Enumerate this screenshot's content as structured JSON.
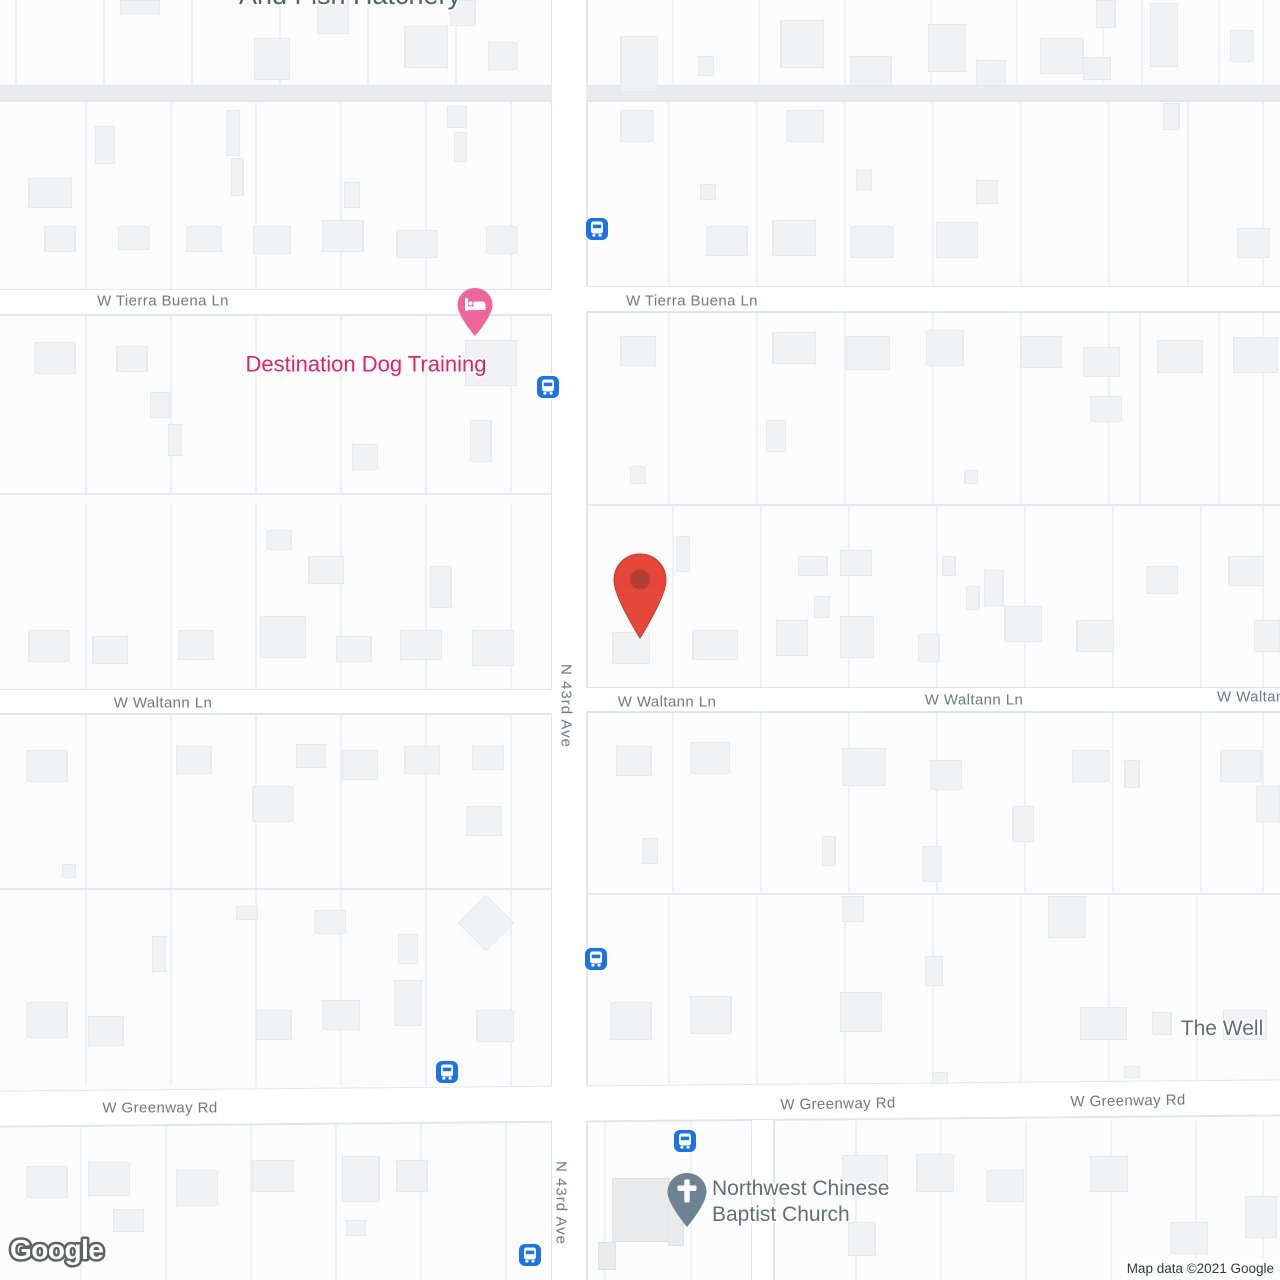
{
  "colors": {
    "land": "#fcfcfd",
    "road_fill": "#ffffff",
    "road_minor_fill": "#e9ebee",
    "road_casing": "#e2e5e9",
    "parcel_line": "#eef0f3",
    "building_fill": "#f1f2f4",
    "street_label": "#6b7a87",
    "poi_slate": "#5f7077",
    "poi_dark_slate": "#4a6570",
    "poi_pink": "#e8205f",
    "lodging_pin_pink": "#f0659a",
    "red_pin": "#e5473b",
    "red_pin_dot": "#b23e33",
    "church_pin": "#6d8292",
    "bus_blue": "#1a73e8",
    "watermark_outline": "#5e6267",
    "attribution_text": "#33373b"
  },
  "attribution": {
    "logo": "Google",
    "copyright": "Map data ©2021 Google"
  },
  "map": {
    "roads": [
      {
        "name": "road-top-minor",
        "type": "minor",
        "x": 0,
        "y": 86,
        "w": 1280,
        "h": 14
      },
      {
        "name": "road-tierra-buena-west",
        "type": "street",
        "x": 0,
        "y": 290,
        "w": 552,
        "h": 24
      },
      {
        "name": "road-tierra-buena-east",
        "type": "street",
        "x": 586,
        "y": 287,
        "w": 694,
        "h": 24
      },
      {
        "name": "road-waltann-west",
        "type": "street",
        "x": 0,
        "y": 690,
        "w": 552,
        "h": 23
      },
      {
        "name": "road-waltann-east",
        "type": "street",
        "x": 586,
        "y": 688,
        "w": 694,
        "h": 23
      },
      {
        "name": "road-n-43rd-ave",
        "type": "avenue",
        "x": 552,
        "y": 0,
        "w": 34,
        "h": 1280
      },
      {
        "name": "road-greenway",
        "type": "street",
        "x": -2,
        "y": 1086,
        "w": 1284,
        "h": 34,
        "rot": -0.5
      },
      {
        "name": "road-church-lane",
        "type": "lane",
        "x": 752,
        "y": 1120,
        "w": 21,
        "h": 160
      }
    ],
    "block_lines": [
      {
        "y": 493,
        "x1": 0,
        "x2": 552
      },
      {
        "y": 504,
        "x1": 586,
        "x2": 1280
      },
      {
        "y": 888,
        "x1": 0,
        "x2": 552
      },
      {
        "y": 893,
        "x1": 586,
        "x2": 1280
      }
    ],
    "parcel_groups": [
      {
        "xs": [
          15,
          103,
          191,
          279,
          367,
          455
        ],
        "y1": 0,
        "y2": 86
      },
      {
        "xs": [
          672,
          758,
          844,
          930,
          1016,
          1102,
          1141,
          1218,
          1262
        ],
        "y1": 0,
        "y2": 86
      },
      {
        "xs": [
          85,
          170,
          255,
          340,
          425,
          510
        ],
        "y1": 100,
        "y2": 290
      },
      {
        "xs": [
          668,
          756,
          844,
          932,
          1020,
          1108,
          1187,
          1262
        ],
        "y1": 100,
        "y2": 287
      },
      {
        "xs": [
          85,
          170,
          255,
          340,
          425,
          510
        ],
        "y1": 314,
        "y2": 493
      },
      {
        "xs": [
          668,
          756,
          844,
          932,
          1020,
          1108,
          1139,
          1218,
          1262
        ],
        "y1": 311,
        "y2": 504
      },
      {
        "xs": [
          85,
          170,
          255,
          340,
          425,
          510
        ],
        "y1": 504,
        "y2": 690
      },
      {
        "xs": [
          672,
          760,
          848,
          936,
          1024,
          1112,
          1200,
          1262
        ],
        "y1": 504,
        "y2": 688
      },
      {
        "xs": [
          85,
          170,
          255,
          340,
          425,
          510
        ],
        "y1": 713,
        "y2": 888
      },
      {
        "xs": [
          672,
          760,
          848,
          936,
          1024,
          1112,
          1200,
          1262
        ],
        "y1": 711,
        "y2": 893
      },
      {
        "xs": [
          85,
          170,
          255,
          340,
          425,
          510
        ],
        "y1": 888,
        "y2": 1086
      },
      {
        "xs": [
          668,
          756,
          844,
          932,
          1020,
          1108,
          1196
        ],
        "y1": 893,
        "y2": 1084
      },
      {
        "xs": [
          80,
          165,
          250,
          335,
          420,
          505
        ],
        "y1": 1121,
        "y2": 1280
      },
      {
        "xs": [
          604,
          690,
          855,
          940,
          1025,
          1110,
          1195,
          1262
        ],
        "y1": 1121,
        "y2": 1280
      }
    ],
    "buildings": [
      [
        120,
        0,
        40,
        14
      ],
      [
        254,
        38,
        36,
        42
      ],
      [
        317,
        0,
        32,
        34
      ],
      [
        404,
        26,
        44,
        42
      ],
      [
        450,
        0,
        26,
        26
      ],
      [
        488,
        42,
        30,
        28
      ],
      [
        28,
        178,
        44,
        30
      ],
      [
        44,
        226,
        32,
        26
      ],
      [
        95,
        126,
        20,
        38
      ],
      [
        118,
        226,
        32,
        24
      ],
      [
        186,
        226,
        36,
        26
      ],
      [
        226,
        110,
        14,
        46
      ],
      [
        231,
        158,
        13,
        38
      ],
      [
        253,
        226,
        38,
        28
      ],
      [
        322,
        220,
        42,
        32
      ],
      [
        344,
        182,
        16,
        26
      ],
      [
        396,
        230,
        42,
        28
      ],
      [
        447,
        106,
        20,
        22
      ],
      [
        454,
        132,
        13,
        30
      ],
      [
        486,
        226,
        32,
        28
      ],
      [
        34,
        342,
        42,
        32
      ],
      [
        116,
        346,
        32,
        26
      ],
      [
        150,
        392,
        20,
        26
      ],
      [
        168,
        424,
        14,
        32
      ],
      [
        352,
        444,
        26,
        26
      ],
      [
        470,
        420,
        22,
        42
      ],
      [
        465,
        340,
        52,
        46
      ],
      [
        28,
        630,
        42,
        32
      ],
      [
        92,
        636,
        36,
        28
      ],
      [
        178,
        630,
        36,
        30
      ],
      [
        260,
        616,
        46,
        42
      ],
      [
        308,
        556,
        36,
        28
      ],
      [
        336,
        636,
        36,
        26
      ],
      [
        400,
        630,
        42,
        30
      ],
      [
        430,
        566,
        22,
        42
      ],
      [
        472,
        630,
        42,
        36
      ],
      [
        266,
        530,
        26,
        20
      ],
      [
        26,
        750,
        42,
        32
      ],
      [
        176,
        746,
        36,
        28
      ],
      [
        252,
        786,
        42,
        36
      ],
      [
        296,
        744,
        30,
        24
      ],
      [
        342,
        750,
        36,
        30
      ],
      [
        404,
        746,
        36,
        28
      ],
      [
        466,
        806,
        36,
        30
      ],
      [
        472,
        746,
        32,
        24
      ],
      [
        62,
        864,
        14,
        14
      ],
      [
        26,
        1002,
        42,
        36
      ],
      [
        88,
        1016,
        36,
        30
      ],
      [
        152,
        936,
        14,
        36
      ],
      [
        236,
        906,
        22,
        14
      ],
      [
        256,
        1010,
        36,
        30
      ],
      [
        314,
        910,
        32,
        24
      ],
      [
        322,
        1000,
        38,
        30
      ],
      [
        394,
        980,
        28,
        46
      ],
      [
        398,
        934,
        20,
        30
      ],
      [
        476,
        1010,
        38,
        32
      ],
      [
        466,
        903,
        40,
        40,
        "r45"
      ],
      [
        26,
        1166,
        42,
        32
      ],
      [
        88,
        1162,
        42,
        34
      ],
      [
        176,
        1170,
        42,
        36
      ],
      [
        252,
        1160,
        42,
        32
      ],
      [
        342,
        1156,
        38,
        46
      ],
      [
        346,
        1220,
        20,
        16
      ],
      [
        396,
        1160,
        32,
        32
      ],
      [
        113,
        1209,
        31,
        23
      ],
      [
        620,
        36,
        38,
        56
      ],
      [
        698,
        56,
        16,
        20
      ],
      [
        780,
        20,
        44,
        48
      ],
      [
        850,
        56,
        42,
        30
      ],
      [
        928,
        24,
        38,
        48
      ],
      [
        976,
        60,
        30,
        26
      ],
      [
        1040,
        38,
        44,
        36
      ],
      [
        1096,
        0,
        20,
        28
      ],
      [
        1150,
        3,
        28,
        64
      ],
      [
        1230,
        30,
        24,
        32
      ],
      [
        1083,
        57,
        28,
        23
      ],
      [
        620,
        110,
        34,
        32
      ],
      [
        706,
        226,
        42,
        30
      ],
      [
        700,
        184,
        16,
        16
      ],
      [
        772,
        220,
        44,
        36
      ],
      [
        786,
        110,
        38,
        32
      ],
      [
        850,
        226,
        44,
        32
      ],
      [
        856,
        170,
        16,
        20
      ],
      [
        936,
        222,
        42,
        36
      ],
      [
        976,
        180,
        22,
        24
      ],
      [
        1163,
        103,
        17,
        27
      ],
      [
        1237,
        228,
        33,
        30
      ],
      [
        620,
        336,
        36,
        30
      ],
      [
        630,
        466,
        16,
        18
      ],
      [
        766,
        420,
        20,
        32
      ],
      [
        772,
        332,
        44,
        32
      ],
      [
        846,
        336,
        44,
        34
      ],
      [
        926,
        330,
        38,
        36
      ],
      [
        964,
        470,
        14,
        14
      ],
      [
        1020,
        336,
        42,
        32
      ],
      [
        1090,
        396,
        32,
        26
      ],
      [
        1157,
        340,
        46,
        33
      ],
      [
        1083,
        347,
        37,
        30
      ],
      [
        1233,
        337,
        45,
        36
      ],
      [
        612,
        632,
        38,
        32
      ],
      [
        676,
        536,
        14,
        36
      ],
      [
        692,
        630,
        46,
        30
      ],
      [
        776,
        620,
        32,
        36
      ],
      [
        798,
        556,
        30,
        20
      ],
      [
        814,
        596,
        16,
        22
      ],
      [
        840,
        550,
        32,
        26
      ],
      [
        840,
        616,
        34,
        42
      ],
      [
        918,
        634,
        22,
        28
      ],
      [
        942,
        556,
        14,
        20
      ],
      [
        966,
        586,
        14,
        24
      ],
      [
        984,
        570,
        20,
        36
      ],
      [
        1004,
        606,
        38,
        36
      ],
      [
        1076,
        620,
        38,
        32
      ],
      [
        1146,
        566,
        32,
        28
      ],
      [
        1228,
        556,
        36,
        30
      ],
      [
        1254,
        620,
        26,
        32
      ],
      [
        616,
        746,
        36,
        30
      ],
      [
        690,
        742,
        40,
        32
      ],
      [
        642,
        838,
        16,
        26
      ],
      [
        822,
        836,
        14,
        30
      ],
      [
        842,
        748,
        44,
        38
      ],
      [
        922,
        846,
        20,
        36
      ],
      [
        930,
        760,
        32,
        30
      ],
      [
        1012,
        806,
        22,
        36
      ],
      [
        1072,
        750,
        38,
        32
      ],
      [
        1124,
        760,
        16,
        28
      ],
      [
        1220,
        750,
        42,
        32
      ],
      [
        1256,
        786,
        24,
        36
      ],
      [
        610,
        1002,
        42,
        38
      ],
      [
        690,
        996,
        42,
        38
      ],
      [
        842,
        896,
        22,
        26
      ],
      [
        840,
        992,
        42,
        40
      ],
      [
        925,
        956,
        18,
        30
      ],
      [
        932,
        1072,
        16,
        12
      ],
      [
        1048,
        896,
        38,
        42
      ],
      [
        1080,
        1007,
        47,
        33
      ],
      [
        1152,
        1012,
        20,
        23
      ],
      [
        1124,
        1066,
        16,
        12
      ],
      [
        1223,
        1010,
        44,
        30
      ],
      [
        612,
        1178,
        58,
        64,
        "d"
      ],
      [
        598,
        1242,
        18,
        28,
        "d"
      ],
      [
        668,
        1196,
        16,
        50,
        "d"
      ],
      [
        842,
        1155,
        46,
        38
      ],
      [
        848,
        1222,
        28,
        34
      ],
      [
        916,
        1154,
        38,
        38
      ],
      [
        986,
        1170,
        38,
        32
      ],
      [
        1090,
        1156,
        38,
        36
      ],
      [
        1170,
        1222,
        38,
        32
      ],
      [
        1245,
        1196,
        32,
        42
      ]
    ],
    "street_labels": [
      {
        "name": "street-label-tierra-buena-west",
        "text": "W Tierra Buena Ln",
        "x": 163,
        "y": 301
      },
      {
        "name": "street-label-tierra-buena-east",
        "text": "W Tierra Buena Ln",
        "x": 692,
        "y": 301
      },
      {
        "name": "street-label-waltann-west",
        "text": "W Waltann Ln",
        "x": 163,
        "y": 703
      },
      {
        "name": "street-label-waltann-mid",
        "text": "W Waltann Ln",
        "x": 667,
        "y": 702
      },
      {
        "name": "street-label-waltann-east",
        "text": "W Waltann Ln",
        "x": 974,
        "y": 700
      },
      {
        "name": "street-label-waltann-clipped",
        "text": "W Waltann Ln",
        "x": 1217,
        "y": 697,
        "anchor": "left"
      },
      {
        "name": "street-label-greenway-west",
        "text": "W Greenway Rd",
        "x": 160,
        "y": 1108
      },
      {
        "name": "street-label-greenway-mid",
        "text": "W Greenway Rd",
        "x": 838,
        "y": 1104,
        "rot": -1
      },
      {
        "name": "street-label-greenway-east",
        "text": "W Greenway Rd",
        "x": 1128,
        "y": 1101,
        "rot": -1
      },
      {
        "name": "street-label-n-43rd-ave-top",
        "text": "N 43rd Ave",
        "x": 566,
        "y": 706,
        "vertical": true
      },
      {
        "name": "street-label-n-43rd-ave-bottom",
        "text": "N 43rd Ave",
        "x": 561,
        "y": 1203,
        "vertical": true
      }
    ],
    "poi_labels": [
      {
        "name": "poi-label-fish-hatchery",
        "lines": [
          "And Fish Hatchery"
        ],
        "x": 350,
        "y": -4,
        "color": "#4a6570",
        "size": 27,
        "align": "center",
        "interactable": true
      },
      {
        "name": "poi-label-destination-dog-training",
        "lines": [
          "Destination Dog Training"
        ],
        "x": 366,
        "y": 364,
        "color": "#e8205f",
        "size": 22,
        "align": "center",
        "interactable": true
      },
      {
        "name": "poi-label-northwest-chinese-baptist-church",
        "lines": [
          "Northwest Chinese",
          "Baptist Church"
        ],
        "x": 712,
        "y": 1176,
        "color": "#5f7077",
        "size": 21,
        "align": "left",
        "interactable": true
      },
      {
        "name": "poi-label-the-well",
        "lines": [
          "The Well"
        ],
        "x": 1222,
        "y": 1029,
        "color": "#5f7077",
        "size": 21,
        "align": "center",
        "interactable": true
      }
    ],
    "bus_stops": [
      [
        597,
        229
      ],
      [
        548,
        387
      ],
      [
        596,
        959
      ],
      [
        447,
        1072
      ],
      [
        685,
        1141
      ],
      [
        530,
        1255
      ]
    ],
    "markers": {
      "red_pin": {
        "name": "destination-red-pin-marker",
        "x": 640,
        "y": 640
      },
      "lodging_pin": {
        "name": "lodging-pin-marker",
        "x": 475,
        "y": 337
      },
      "church_pin": {
        "name": "church-pin-marker",
        "x": 687,
        "y": 1228
      }
    }
  }
}
